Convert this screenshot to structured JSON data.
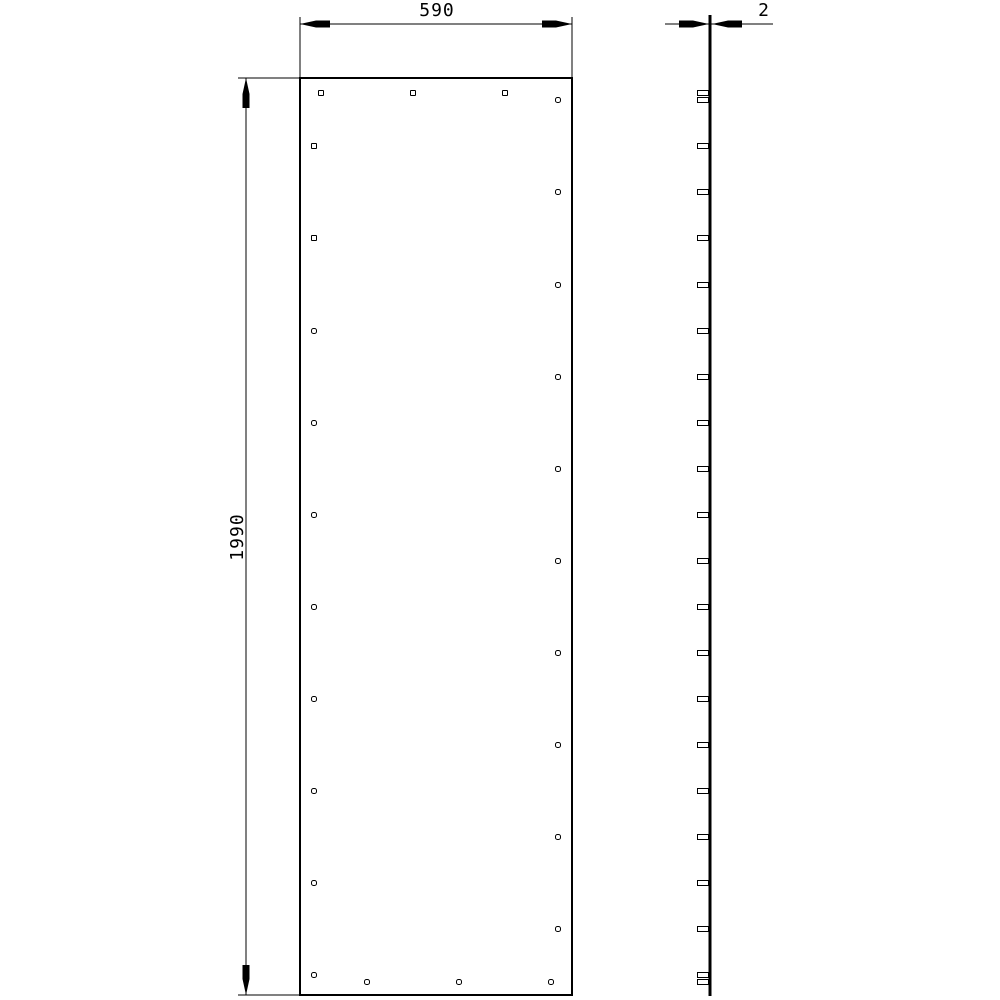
{
  "drawing": {
    "type": "technical-drawing",
    "description": "Flat panel front view and edge view",
    "colors": {
      "line": "#000000",
      "background": "#ffffff"
    }
  },
  "front_view": {
    "outline": {
      "x": 300,
      "y": 78,
      "width": 272,
      "height": 917
    },
    "hole_size": 5,
    "holes": [
      {
        "cx": 321,
        "cy": 93,
        "shape": "square"
      },
      {
        "cx": 413,
        "cy": 93,
        "shape": "square"
      },
      {
        "cx": 505,
        "cy": 93,
        "shape": "square"
      },
      {
        "cx": 314,
        "cy": 146,
        "shape": "square"
      },
      {
        "cx": 314,
        "cy": 238,
        "shape": "square"
      },
      {
        "cx": 314,
        "cy": 331,
        "shape": "round"
      },
      {
        "cx": 314,
        "cy": 423,
        "shape": "round"
      },
      {
        "cx": 314,
        "cy": 515,
        "shape": "round"
      },
      {
        "cx": 314,
        "cy": 607,
        "shape": "round"
      },
      {
        "cx": 314,
        "cy": 699,
        "shape": "round"
      },
      {
        "cx": 314,
        "cy": 791,
        "shape": "round"
      },
      {
        "cx": 314,
        "cy": 883,
        "shape": "round"
      },
      {
        "cx": 314,
        "cy": 975,
        "shape": "round"
      },
      {
        "cx": 558,
        "cy": 100,
        "shape": "round"
      },
      {
        "cx": 558,
        "cy": 192,
        "shape": "round"
      },
      {
        "cx": 558,
        "cy": 285,
        "shape": "round"
      },
      {
        "cx": 558,
        "cy": 377,
        "shape": "round"
      },
      {
        "cx": 558,
        "cy": 469,
        "shape": "round"
      },
      {
        "cx": 558,
        "cy": 561,
        "shape": "round"
      },
      {
        "cx": 558,
        "cy": 653,
        "shape": "round"
      },
      {
        "cx": 558,
        "cy": 745,
        "shape": "round"
      },
      {
        "cx": 558,
        "cy": 837,
        "shape": "round"
      },
      {
        "cx": 558,
        "cy": 929,
        "shape": "round"
      },
      {
        "cx": 367,
        "cy": 982,
        "shape": "round"
      },
      {
        "cx": 459,
        "cy": 982,
        "shape": "round"
      },
      {
        "cx": 551,
        "cy": 982,
        "shape": "round"
      }
    ]
  },
  "side_view": {
    "edge": {
      "x": 710,
      "y1": 15,
      "y2": 996,
      "stroke_width": 3
    },
    "slot": {
      "width": 11,
      "height": 5
    },
    "slots_cy": [
      93,
      100,
      146,
      192,
      238,
      285,
      331,
      377,
      423,
      469,
      515,
      561,
      607,
      653,
      699,
      745,
      791,
      837,
      883,
      929,
      975,
      982
    ]
  },
  "dimensions": {
    "width": {
      "label": "590",
      "line": {
        "x1": 300,
        "y1": 24,
        "x2": 572,
        "y2": 24
      },
      "extension_lines": [
        {
          "x1": 300,
          "y1": 17,
          "x2": 300,
          "y2": 78
        },
        {
          "x1": 572,
          "y1": 17,
          "x2": 572,
          "y2": 78
        }
      ],
      "arrows": [
        {
          "tip": [
            300,
            24
          ],
          "dir": "left"
        },
        {
          "tip": [
            572,
            24
          ],
          "dir": "right"
        }
      ],
      "text_anchor": {
        "x": 437,
        "y": 16,
        "rotate": 0
      }
    },
    "height": {
      "label": "1990",
      "line": {
        "x1": 246,
        "y1": 78,
        "x2": 246,
        "y2": 995
      },
      "extension_lines": [
        {
          "x1": 238,
          "y1": 78,
          "x2": 300,
          "y2": 78
        },
        {
          "x1": 238,
          "y1": 995,
          "x2": 300,
          "y2": 995
        }
      ],
      "arrows": [
        {
          "tip": [
            246,
            78
          ],
          "dir": "up"
        },
        {
          "tip": [
            246,
            995
          ],
          "dir": "down"
        }
      ],
      "text_anchor": {
        "x": 243,
        "y": 537,
        "rotate": -90
      }
    },
    "thickness": {
      "label": "2",
      "line": {
        "x1": 665,
        "y1": 24,
        "x2": 773,
        "y2": 24
      },
      "extension_lines": [],
      "arrows": [
        {
          "tip": [
            709,
            24
          ],
          "dir": "right"
        },
        {
          "tip": [
            712,
            24
          ],
          "dir": "left"
        }
      ],
      "text_anchor": {
        "x": 764,
        "y": 16,
        "rotate": 0
      }
    }
  }
}
